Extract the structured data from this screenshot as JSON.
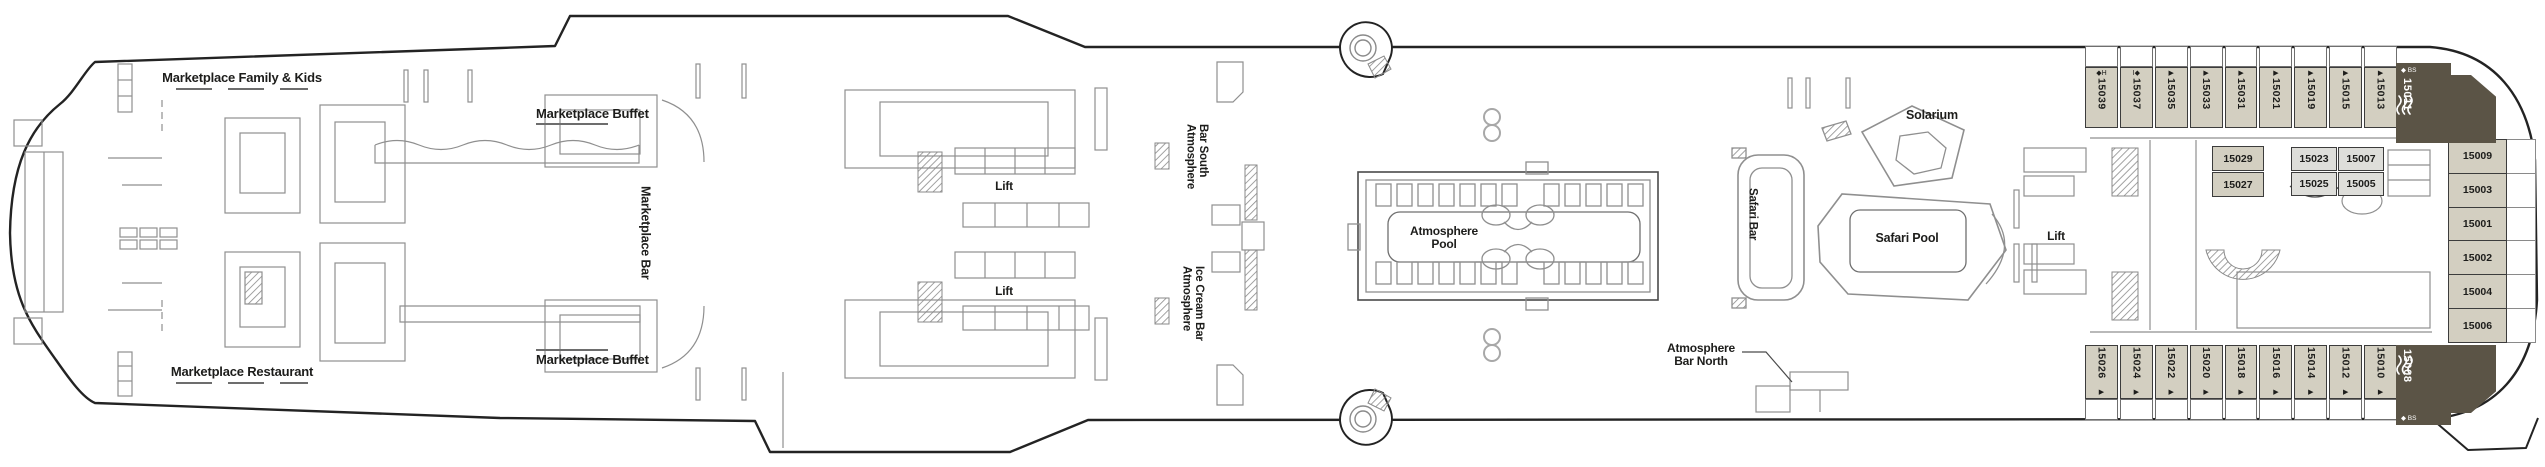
{
  "colors": {
    "cabin_tan": "#d3cfc1",
    "cabin_dark": "#5b5446",
    "cabin_light": "#dededa",
    "line": "#1d1d1b"
  },
  "venues": {
    "lift_label": "Lift",
    "marketplace_family_kids": "Marketplace Family & Kids",
    "marketplace_buffet_top": "Marketplace Buffet",
    "marketplace_bar": "Marketplace Bar",
    "marketplace_restaurant": "Marketplace Restaurant",
    "marketplace_buffet_bottom": "Marketplace Buffet",
    "atmosphere_bar_south": {
      "line1": "Atmosphere",
      "line2": "Bar South"
    },
    "atmosphere_ice_cream_bar": {
      "line1": "Atmosphere",
      "line2": "Ice Cream Bar"
    },
    "atmosphere_pool": {
      "line1": "Atmosphere",
      "line2": "Pool"
    },
    "atmosphere_bar_north": {
      "line1": "Atmosphere",
      "line2": "Bar North"
    },
    "solarium": "Solarium",
    "safari_bar": "Safari Bar",
    "safari_pool": "Safari Pool"
  },
  "cabins": {
    "top_row": [
      {
        "number": "15039",
        "marks": "◆H"
      },
      {
        "number": "15037",
        "marks": "I◆"
      },
      {
        "number": "15035",
        "marks": "▶"
      },
      {
        "number": "15033",
        "marks": "▶"
      },
      {
        "number": "15031",
        "marks": "▶"
      },
      {
        "number": "15021",
        "marks": "▶"
      },
      {
        "number": "15019",
        "marks": "▶"
      },
      {
        "number": "15015",
        "marks": "▶"
      },
      {
        "number": "15013",
        "marks": "▶"
      }
    ],
    "bottom_row": [
      {
        "number": "15026",
        "marks": "▶"
      },
      {
        "number": "15024",
        "marks": "▶"
      },
      {
        "number": "15022",
        "marks": "▶"
      },
      {
        "number": "15020",
        "marks": "▶"
      },
      {
        "number": "15018",
        "marks": "▶"
      },
      {
        "number": "15016",
        "marks": "▶"
      },
      {
        "number": "15014",
        "marks": "▶"
      },
      {
        "number": "15012",
        "marks": "▶"
      },
      {
        "number": "15010",
        "marks": "▶"
      }
    ],
    "stern_column": [
      {
        "number": "15009"
      },
      {
        "number": "15003"
      },
      {
        "number": "15001"
      },
      {
        "number": "15002"
      },
      {
        "number": "15004"
      },
      {
        "number": "15006"
      }
    ],
    "mid_block_a": [
      {
        "number": "15029"
      },
      {
        "number": "15027"
      }
    ],
    "mid_block_b": [
      {
        "number": "15023"
      },
      {
        "number": "15007"
      },
      {
        "number": "15025"
      },
      {
        "number": "15005"
      }
    ],
    "suite_top": {
      "number": "15011",
      "marks": "◆ BS"
    },
    "suite_bottom": {
      "number": "15008",
      "marks": "◆ BS"
    }
  }
}
